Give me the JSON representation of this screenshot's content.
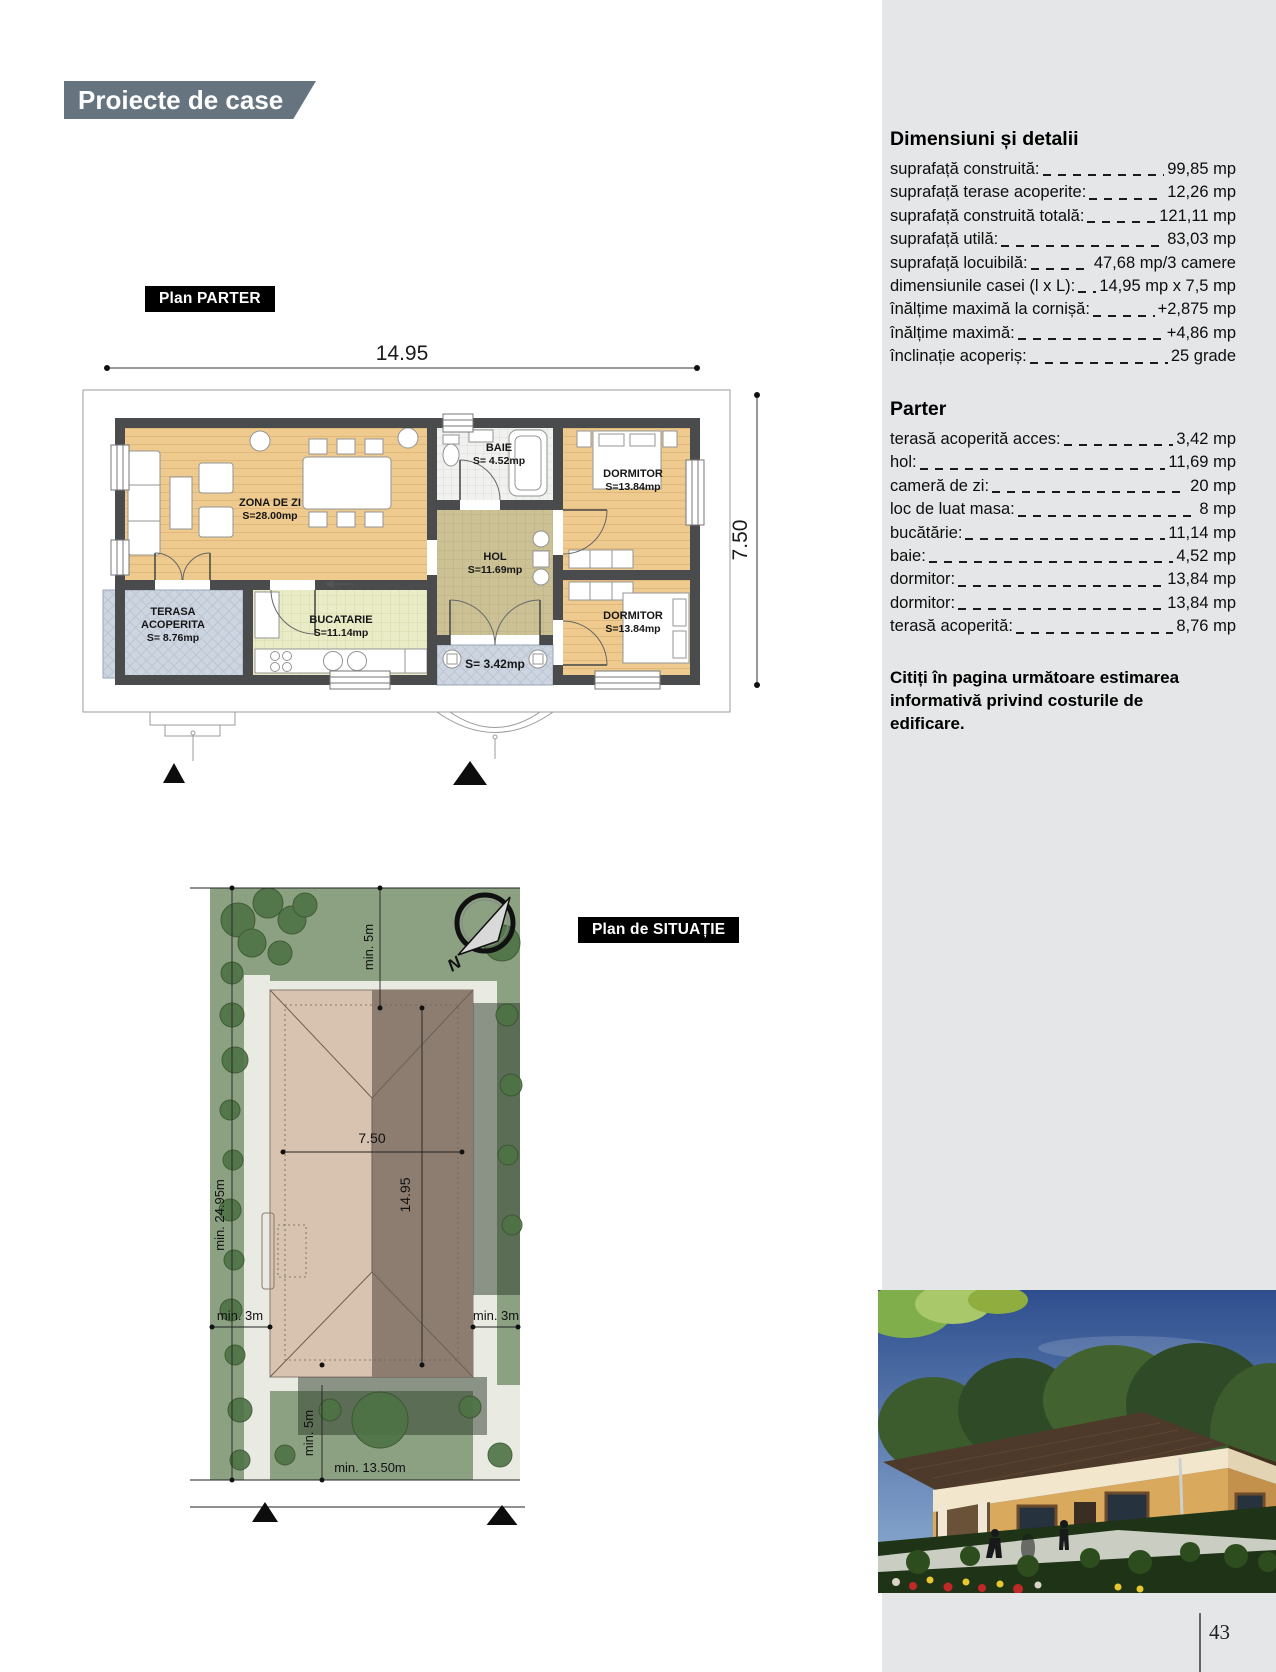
{
  "page": {
    "header_banner": "Proiecte de case",
    "page_number": "43"
  },
  "colors": {
    "banner_bg": "#66747f",
    "sidebar_bg": "#e5e6e7",
    "label_bg": "#000000",
    "floor_tan": "#eeca8e",
    "floor_hol": "#cbc195",
    "floor_kitchen": "#eaecc8",
    "floor_terrace": "#cdd5e0",
    "wall": "#4a4b4d",
    "site_green": "#8ba182",
    "roof_light": "#d7c3af",
    "roof_dark": "#8d7d71"
  },
  "details_panel": {
    "title": "Dimensiuni și detalii",
    "rows": [
      {
        "label": "suprafață construită:",
        "value": "99,85 mp"
      },
      {
        "label": "suprafață terase acoperite:",
        "value": "12,26 mp"
      },
      {
        "label": "suprafață construită totală:",
        "value": "121,11 mp"
      },
      {
        "label": "suprafață utilă:",
        "value": "83,03 mp"
      },
      {
        "label": "suprafață locuibilă:",
        "value": "47,68 mp/3 camere"
      },
      {
        "label": "dimensiunile casei (l x L):",
        "value": "14,95 mp x 7,5 mp"
      },
      {
        "label": "înălțime maximă la cornișă:",
        "value": "+2,875 mp"
      },
      {
        "label": "înălțime maximă:",
        "value": "+4,86 mp"
      },
      {
        "label": "înclinație acoperiș:",
        "value": "25 grade"
      }
    ],
    "parter_title": "Parter",
    "parter_rows": [
      {
        "label": "terasă acoperită acces:",
        "value": "3,42 mp"
      },
      {
        "label": "hol:",
        "value": "11,69 mp"
      },
      {
        "label": "cameră de zi:",
        "value": "20 mp"
      },
      {
        "label": "loc de luat masa:",
        "value": "8 mp"
      },
      {
        "label": "bucătărie:",
        "value": "11,14 mp"
      },
      {
        "label": "baie:",
        "value": "4,52 mp"
      },
      {
        "label": "dormitor:",
        "value": "13,84 mp"
      },
      {
        "label": "dormitor:",
        "value": "13,84 mp"
      },
      {
        "label": "terasă acoperită:",
        "value": "8,76 mp"
      }
    ],
    "note": "Citiți în pagina următoare estimarea informativă privind costurile de edificare."
  },
  "floor_plan": {
    "label": "Plan PARTER",
    "dim_width": "14.95",
    "dim_height": "7.50",
    "rooms": {
      "zona_de_zi": {
        "name": "ZONA DE ZI",
        "area": "S=28.00mp"
      },
      "baie": {
        "name": "BAIE",
        "area": "S= 4.52mp"
      },
      "hol": {
        "name": "HOL",
        "area": "S=11.69mp"
      },
      "dormitor1": {
        "name": "DORMITOR",
        "area": "S=13.84mp"
      },
      "dormitor2": {
        "name": "DORMITOR",
        "area": "S=13.84mp"
      },
      "terasa": {
        "name1": "TERASA",
        "name2": "ACOPERITA",
        "area": "S= 8.76mp"
      },
      "bucatarie": {
        "name": "BUCATARIE",
        "area": "S=11.14mp"
      },
      "terasa_acces": {
        "area": "S= 3.42mp"
      }
    }
  },
  "site_plan": {
    "label": "Plan de SITUAȚIE",
    "north_label": "N",
    "dims": {
      "top": "min. 5m",
      "left": "min. 24.95m",
      "house_width": "7.50",
      "house_length": "14.95",
      "left_setback": "min. 3m",
      "right_setback": "min. 3m",
      "bottom": "min. 5m",
      "frontage": "min. 13.50m"
    }
  }
}
